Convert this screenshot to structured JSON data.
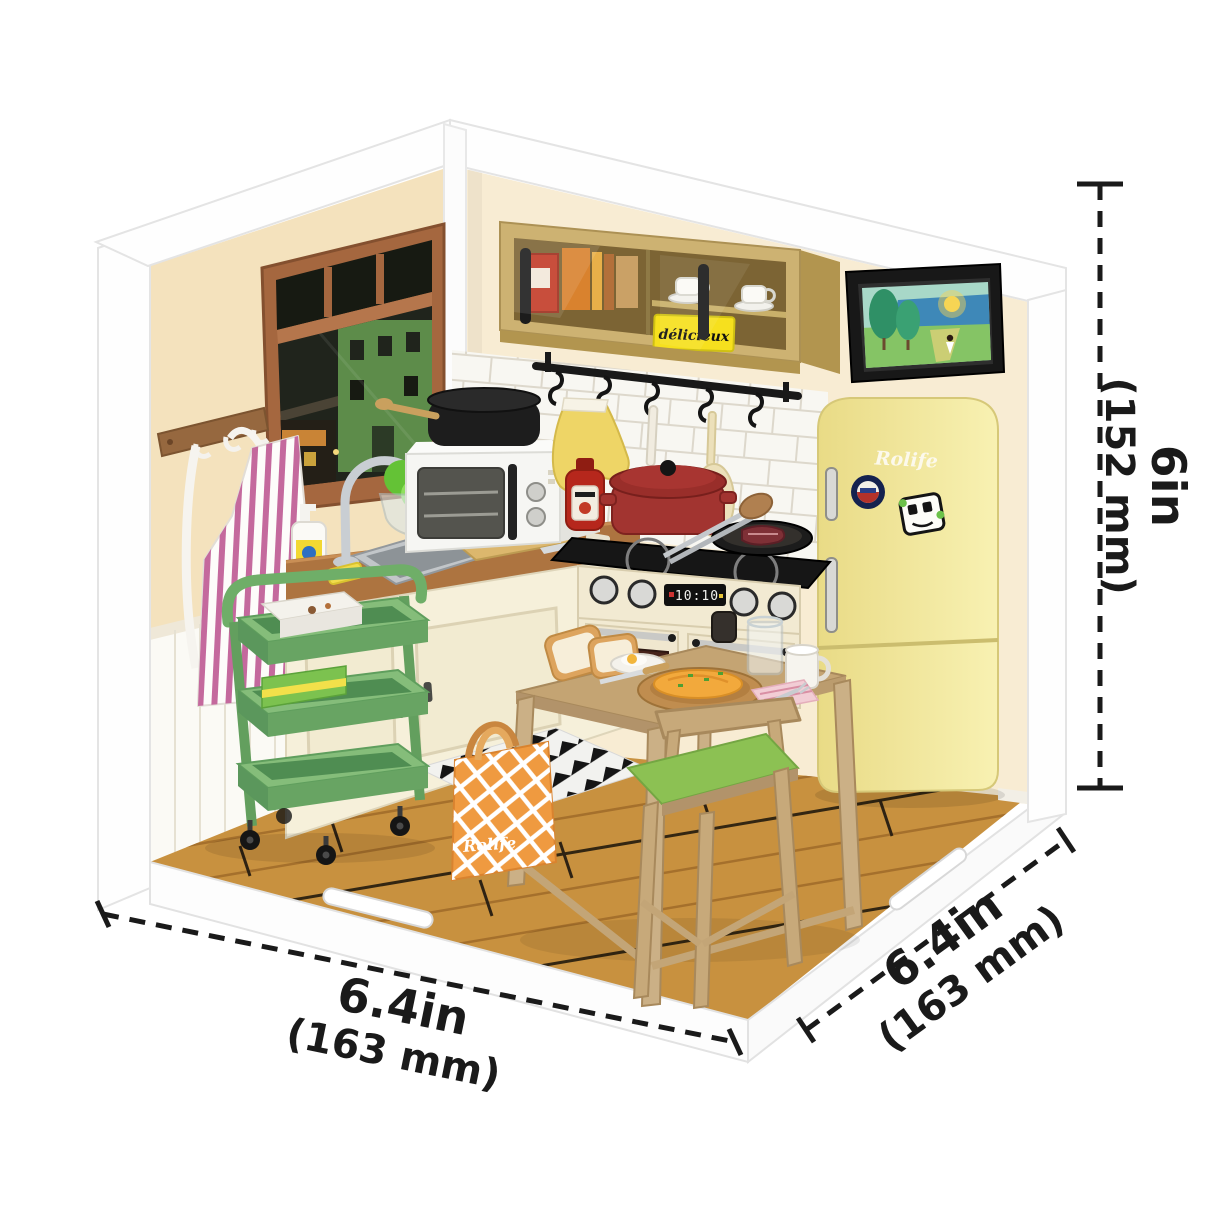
{
  "figure": {
    "type": "product dimension illustration",
    "subject": "miniature kitchen corner diorama kit"
  },
  "labels": {
    "fridge_logo": "Rolife",
    "bag_logo": "Rolife",
    "pantry_box_label": "délicieux",
    "stove_clock": "10:10"
  },
  "dimensions": {
    "height_in": "6in",
    "height_mm": "(152 mm)",
    "width_in": "6.4in",
    "width_mm": "(163 mm)",
    "depth_in": "6.4in",
    "depth_mm": "(163 mm)"
  },
  "colors": {
    "background": "#ffffff",
    "frame_white": "#fdfdfd",
    "wall_left": "#f4e2bd",
    "wall_right": "#f8ecd3",
    "floor_wood": "#c8913f",
    "cabinet_tan": "#cdb272",
    "counter_brown": "#ad7440",
    "fridge_yellow": "#ece083",
    "cart_green": "#6fae68",
    "pot_red": "#a23430",
    "bag_orange": "#ef9a40",
    "cushion_green": "#8cc153",
    "apron_pink": "#c4699d",
    "dimension_ink": "#1a1a1a"
  }
}
